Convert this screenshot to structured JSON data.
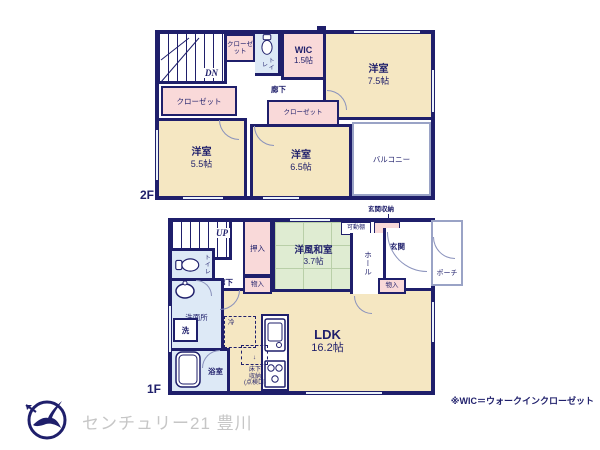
{
  "colors": {
    "wall": "#1f1f6b",
    "room_fill": "#f5e7c2",
    "closet_fill": "#f9d9d9",
    "wet_fill": "#dde9f6",
    "tatami_fill": "#dfecd2",
    "brand_text": "#c6c6c6"
  },
  "floor2": {
    "floor_label": "2F",
    "stairs_label": "DN",
    "closet_top": "クローゼット",
    "toilet": "トイレ",
    "wic_name": "WIC",
    "wic_size": "1.5帖",
    "hallway": "廊下",
    "closet_left": "クローゼット",
    "closet_mid": "クローゼット",
    "room_w55_name": "洋室",
    "room_w55_size": "5.5帖",
    "room_w65_name": "洋室",
    "room_w65_size": "6.5帖",
    "room_w75_name": "洋室",
    "room_w75_size": "7.5帖",
    "balcony": "バルコニー"
  },
  "floor1": {
    "floor_label": "1F",
    "stairs_label": "UP",
    "oshiire": "押入",
    "storage_left": "物入",
    "tatami_name": "洋風和室",
    "tatami_size": "3.7帖",
    "entrance_storage": "玄関収納",
    "movable_shelf": "可動棚",
    "hall": "ホール",
    "entrance": "玄関",
    "porch": "ポーチ",
    "storage_right": "物入",
    "toilet": "トイレ",
    "hallway": "廊下",
    "washroom": "洗面所",
    "washer": "洗",
    "bathroom": "浴室",
    "fridge": "冷",
    "underfloor_l1": "床下",
    "underfloor_l2": "収納",
    "underfloor_l3": "(点検口)",
    "underfloor_arrow": "↓",
    "ldk_name": "LDK",
    "ldk_size": "16.2帖"
  },
  "footer": {
    "brand": "センチュリー21 豊川",
    "note": "※WIC＝ウォークインクローゼット"
  }
}
